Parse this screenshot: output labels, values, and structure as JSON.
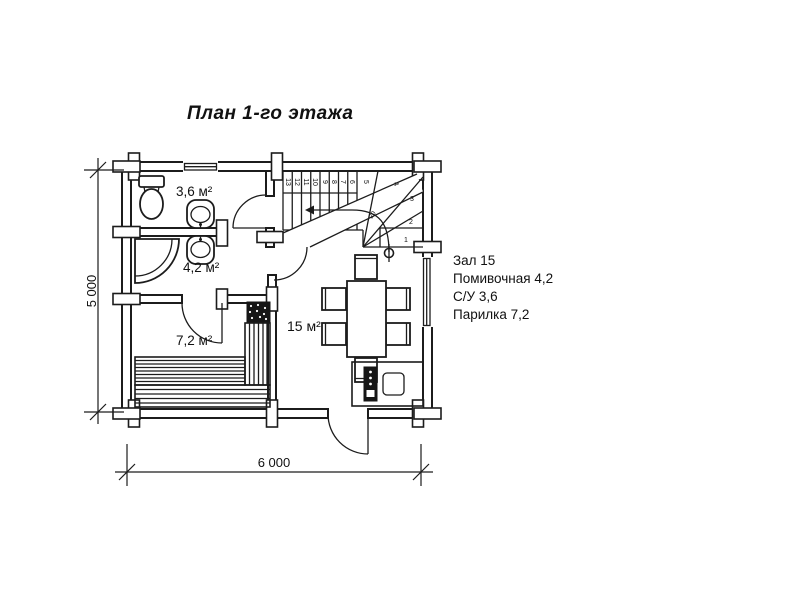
{
  "title": "План 1-го этажа",
  "plan": {
    "room_labels": {
      "wc": "3,6 м²",
      "washing": "4,2 м²",
      "sauna": "7,2 м²",
      "hall": "15 м²"
    },
    "dimensions": {
      "width_label": "6 000",
      "height_label": "5 000"
    },
    "stairs": {
      "steps": [
        "13",
        "12",
        "11",
        "10",
        "9",
        "8",
        "7",
        "6",
        "5",
        "4",
        "3",
        "2",
        "1"
      ],
      "note": "20"
    }
  },
  "legend": {
    "items": [
      "Зал 15",
      "Помивочная 4,2",
      "С/У 3,6",
      "Парилка 7,2"
    ]
  },
  "colors": {
    "line": "#1c1c1c",
    "background": "#ffffff"
  }
}
